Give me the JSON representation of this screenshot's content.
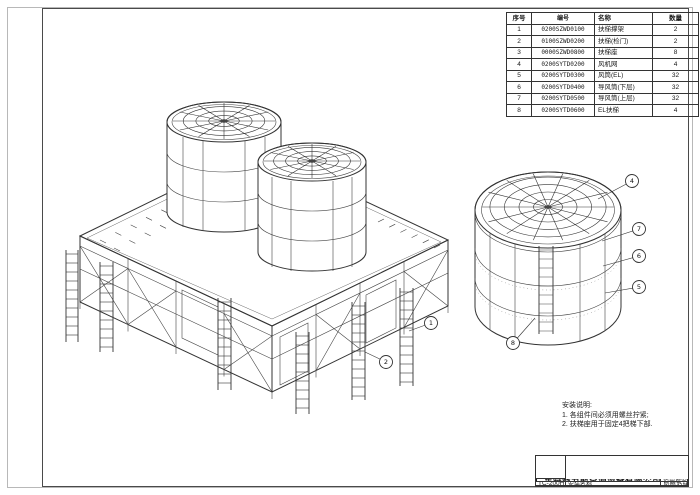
{
  "colors": {
    "ink": "#333333",
    "frame_outer": "#b8b8b8",
    "frame_inner": "#4a4a4a",
    "paper": "#ffffff"
  },
  "parts_table": {
    "headers": [
      "序号",
      "编号",
      "名称",
      "数量"
    ],
    "rows": [
      [
        "1",
        "0200SZWD0100",
        "扶梯撑架",
        "2"
      ],
      [
        "2",
        "0100SZWD0200",
        "扶梯(检门)",
        "2"
      ],
      [
        "3",
        "0000SZWD0800",
        "扶梯座",
        "8"
      ],
      [
        "4",
        "0200SYTD0200",
        "风机网",
        "4"
      ],
      [
        "5",
        "0200SYTD0300",
        "风筒(EL)",
        "32"
      ],
      [
        "6",
        "0200SYTD0400",
        "导风筒(下层)",
        "32"
      ],
      [
        "7",
        "0200SYTD0500",
        "导风筒(上层)",
        "32"
      ],
      [
        "8",
        "0200SYTD0600",
        "EL扶梯",
        "4"
      ]
    ]
  },
  "notes": {
    "title": "安装说明:",
    "line1": "1. 各组件间必须用螺丝拧紧;",
    "line2": "2. 扶梯座用于固定4把梯下部."
  },
  "title_block": {
    "company": "广东特菱节能空调设备有限公司",
    "model_label": "适用塔型",
    "model_value": "TC-200H",
    "name_label": "安装名称",
    "name_value": "风筒及扶梯安装"
  },
  "callouts": {
    "main": [
      "1",
      "2"
    ],
    "detail": [
      "4",
      "7",
      "6",
      "5",
      "8"
    ]
  }
}
